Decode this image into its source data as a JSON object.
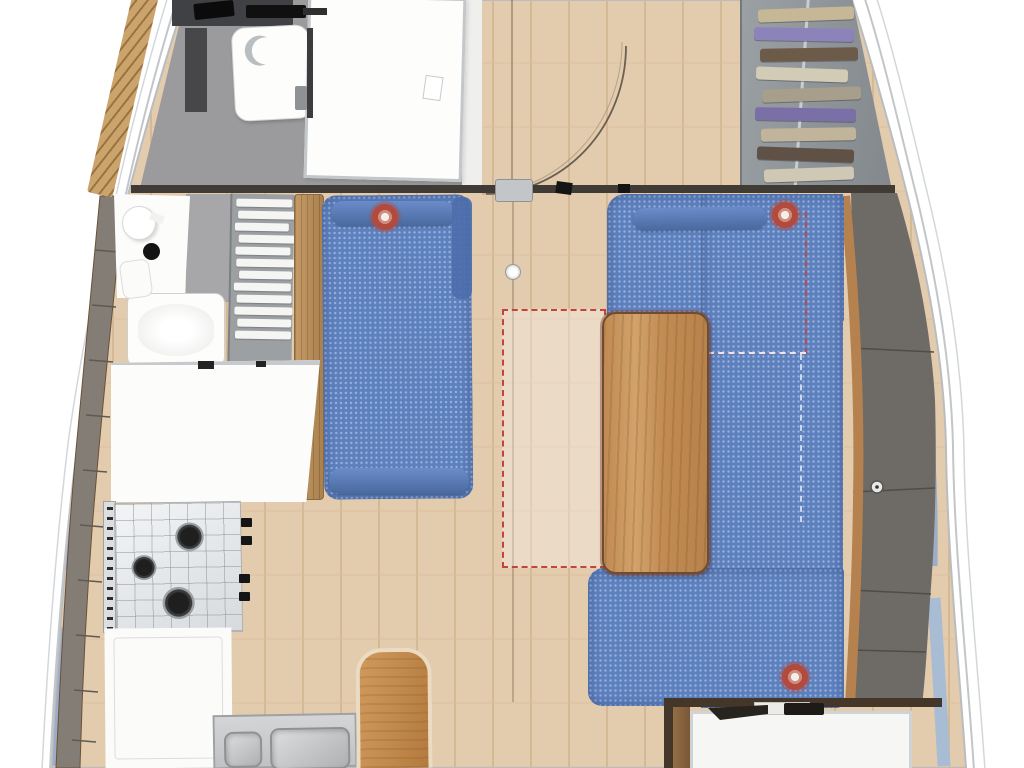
{
  "scene": {
    "kind": "yacht-interior-floor-plan",
    "view": "top-down",
    "canvas_px": {
      "width": 1024,
      "height": 768
    }
  },
  "colors": {
    "page_bg": "#ffffff",
    "floor_wood": "#e3cbae",
    "plank_line": "#d2b48e",
    "upholstery_blue": "#5d80bf",
    "bolster_blue": "#4d6dab",
    "back_cushion_gray": "#6e6a65",
    "cushion_seam": "#504c48",
    "locker_gray": "#847d75",
    "window_blue": "#9dadc8",
    "window_blue_light": "#a8bcd4",
    "trim_wood": "#b5824f",
    "table_wood": "#c89058",
    "bench_wood": "#c9894e",
    "accent_red": "#c2453c",
    "counter_white": "#fcfcfa",
    "steel_gray": "#d8dadc",
    "head_floor_gray": "#9b9b9d",
    "bulkhead_dark": "#403b35",
    "hull_rim_gray": "#c2c6c8",
    "hull_rim_light": "#d4d7d9",
    "door_arc": "#6a5f50"
  },
  "counts": {
    "speakers": 3,
    "stove_burners": 3,
    "sink_bowls": 2,
    "hull_windows_left": 2,
    "hull_windows_right": 3
  },
  "wardrobe": {
    "items": [
      {
        "color": "#c6b897",
        "w": 96,
        "dx": 6,
        "rot": -2
      },
      {
        "color": "#8d83bb",
        "w": 100,
        "dx": 2,
        "rot": 1
      },
      {
        "color": "#6d5b49",
        "w": 98,
        "dx": 8,
        "rot": -1
      },
      {
        "color": "#d2cbb6",
        "w": 92,
        "dx": 4,
        "rot": 2
      },
      {
        "color": "#a89e8c",
        "w": 99,
        "dx": 10,
        "rot": -2
      },
      {
        "color": "#7b6fa8",
        "w": 101,
        "dx": 3,
        "rot": 1
      },
      {
        "color": "#c0b59b",
        "w": 95,
        "dx": 9,
        "rot": -1
      },
      {
        "color": "#5f5146",
        "w": 97,
        "dx": 5,
        "rot": 2
      },
      {
        "color": "#cfc8b4",
        "w": 90,
        "dx": 12,
        "rot": -2
      }
    ]
  },
  "shelf_unit": {
    "slats": [
      {
        "w": 56,
        "dx": 1
      },
      {
        "w": 58,
        "dx": 3
      },
      {
        "w": 54,
        "dx": 0
      },
      {
        "w": 57,
        "dx": 4
      },
      {
        "w": 55,
        "dx": 1
      },
      {
        "w": 58,
        "dx": 2
      },
      {
        "w": 53,
        "dx": 5
      },
      {
        "w": 57,
        "dx": 0
      },
      {
        "w": 55,
        "dx": 3
      },
      {
        "w": 58,
        "dx": 1
      },
      {
        "w": 54,
        "dx": 4
      },
      {
        "w": 56,
        "dx": 2
      }
    ]
  }
}
